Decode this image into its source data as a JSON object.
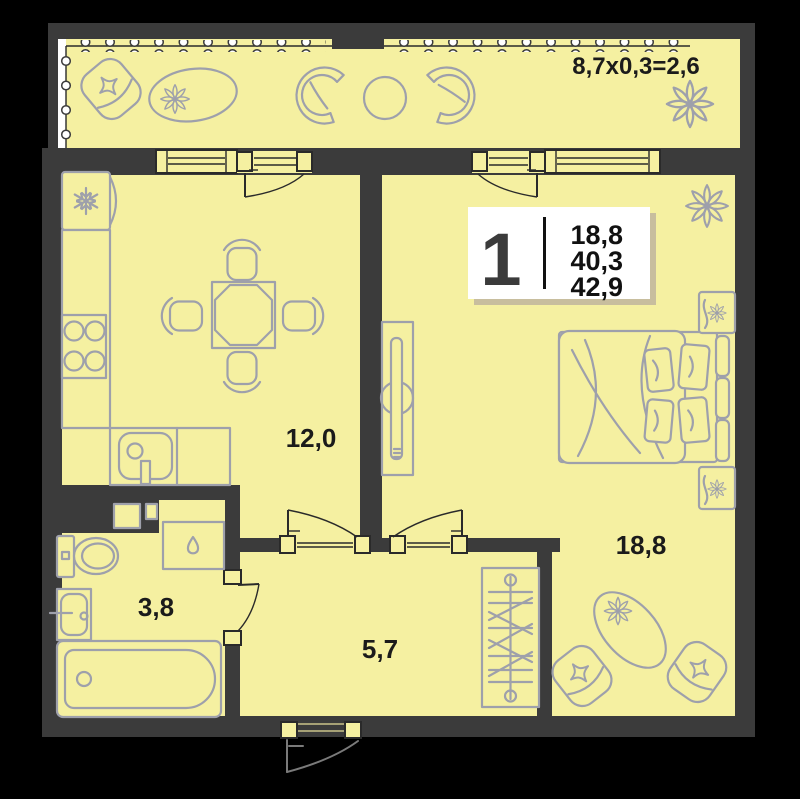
{
  "plan": {
    "balcony": {
      "dimension_label": "8,7x0,3=2,6"
    },
    "info_box": {
      "rooms_count": "1",
      "living_area": "18,8",
      "apartment_area": "40,3",
      "total_area": "42,9"
    },
    "room_labels": {
      "kitchen_living": "12,0",
      "bedroom": "18,8",
      "bathroom": "3,8",
      "hallway": "5,7"
    },
    "colors": {
      "floor": "#F5F0A1",
      "wall": "#3B3B3B",
      "furniture": "#9EA0AB",
      "outline": "#2A2A2A",
      "text": "#1B1B1B",
      "info_shadow": "#C8BE9E",
      "background": "#000000",
      "white": "#FFFFFF"
    },
    "icons": {
      "fridge": "snowflake-icon",
      "washing_machine": "water-drop-icon",
      "plants": "flower-icon",
      "cushions": "star-cushion-icon"
    }
  }
}
